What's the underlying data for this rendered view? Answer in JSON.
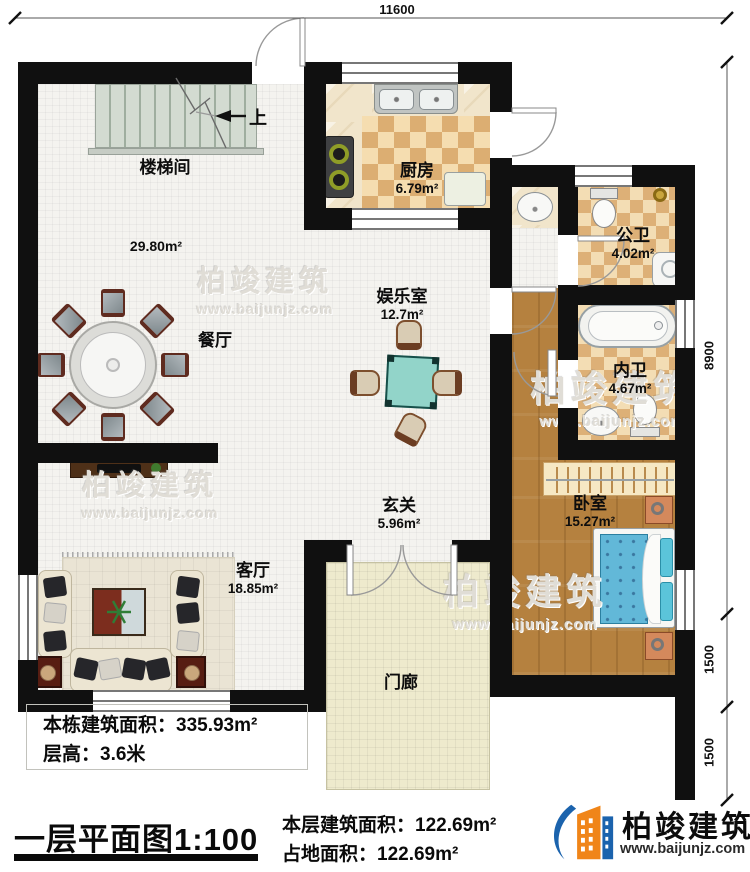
{
  "dimensions": {
    "top_width": "11600",
    "right_upper": "8900",
    "right_middle": "1500",
    "right_lower": "1500"
  },
  "stairs": {
    "up_label": "上"
  },
  "rooms": {
    "stairwell": {
      "name": "楼梯间"
    },
    "hall": {
      "area": "29.80m²"
    },
    "dining": {
      "name": "餐厅"
    },
    "kitchen": {
      "name": "厨房",
      "area": "6.79m²"
    },
    "public_bath": {
      "name": "公卫",
      "area": "4.02m²"
    },
    "inner_bath": {
      "name": "内卫",
      "area": "4.67m²"
    },
    "entertainment": {
      "name": "娱乐室",
      "area": "12.7m²"
    },
    "foyer": {
      "name": "玄关",
      "area": "5.96m²"
    },
    "living": {
      "name": "客厅",
      "area": "18.85m²"
    },
    "bedroom": {
      "name": "卧室",
      "area": "15.27m²"
    },
    "porch": {
      "name": "门廊"
    }
  },
  "info_box": {
    "line1": "本栋建筑面积：335.93m²",
    "line2": "层高：3.6米"
  },
  "footer": {
    "title": "一层平面图1:100",
    "line1": "本层建筑面积：122.69m²",
    "line2": "占地面积：122.69m²"
  },
  "branding": {
    "company": "柏竣建筑",
    "website": "www.baijunjz.com",
    "brand_blue": "#1b63ad",
    "brand_orange": "#f08519"
  },
  "watermark": {
    "company": "柏竣建筑",
    "website": "www.baijunjz.com"
  }
}
